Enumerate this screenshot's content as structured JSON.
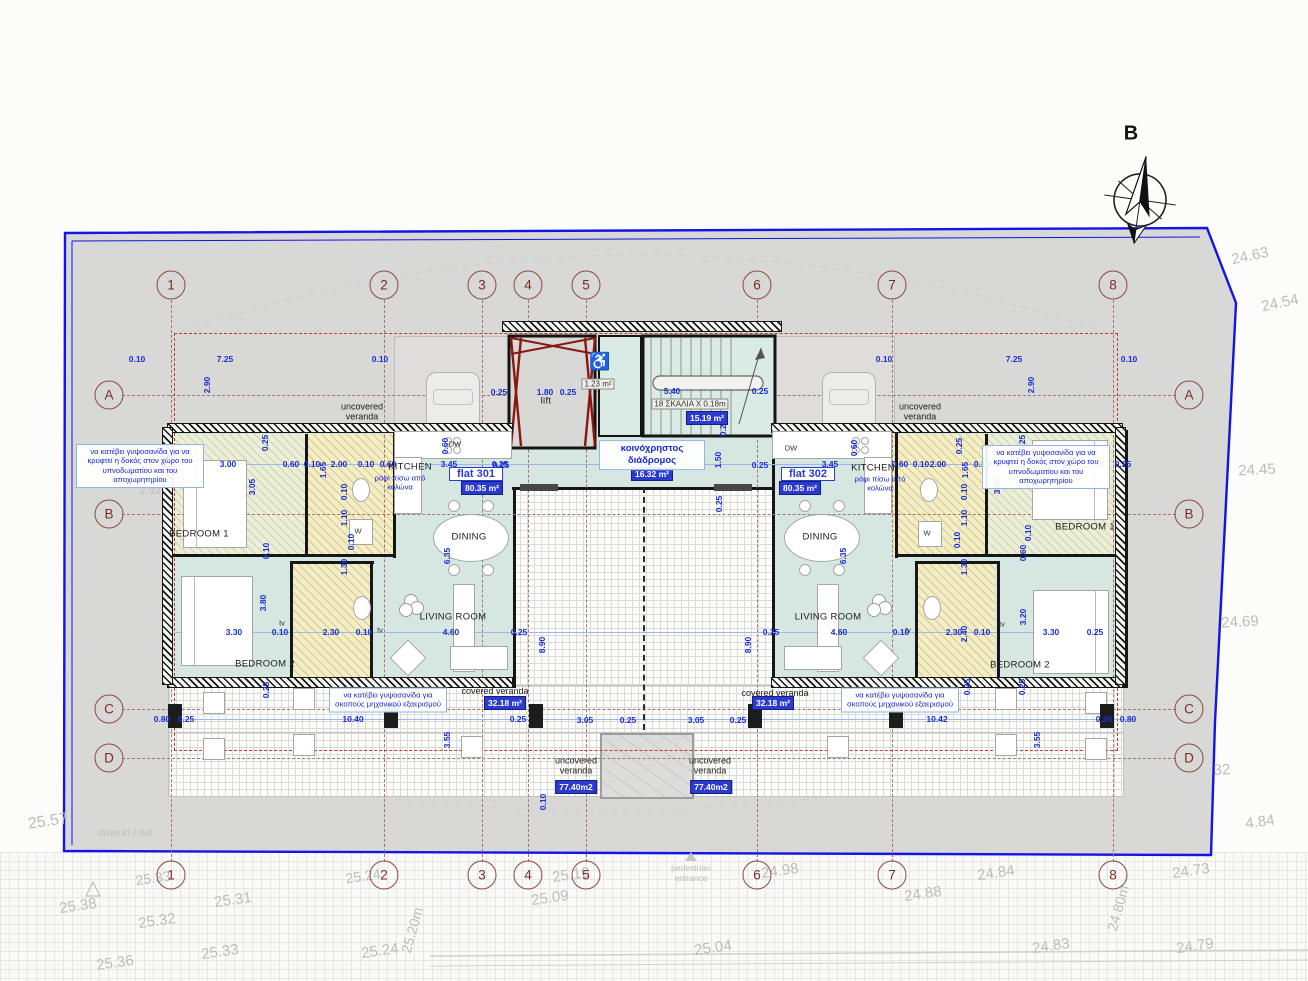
{
  "north": {
    "label": "B"
  },
  "site": {
    "drive": "drive in / out",
    "pedestrian": "pedestrian entrance",
    "boundary_color": "#1414e6"
  },
  "grid": {
    "cols": [
      {
        "n": "1",
        "x": 171
      },
      {
        "n": "2",
        "x": 384
      },
      {
        "n": "3",
        "x": 482
      },
      {
        "n": "4",
        "x": 528
      },
      {
        "n": "5",
        "x": 586
      },
      {
        "n": "6",
        "x": 757
      },
      {
        "n": "7",
        "x": 892
      },
      {
        "n": "8",
        "x": 1113
      }
    ],
    "rows": [
      {
        "n": "A",
        "y": 395
      },
      {
        "n": "B",
        "y": 514
      },
      {
        "n": "C",
        "y": 709
      },
      {
        "n": "D",
        "y": 758
      }
    ]
  },
  "flats": [
    {
      "name": "flat 301",
      "area": "80.35 m²"
    },
    {
      "name": "flat 302",
      "area": "80.35 m²"
    }
  ],
  "core": {
    "lift_label": "lift",
    "accessible": "♿",
    "wc_area": "1.23 m²",
    "stair_note": "18 ΣΚΑΛΙΑ X 0.18m",
    "stair_area": "15.19 m²",
    "corridor_label": "κοινόχρηστος διάδρομος",
    "corridor_area": "16.32 m²"
  },
  "rooms": [
    [
      "KITCHEN",
      410,
      467
    ],
    [
      "KITCHEN",
      873,
      468
    ],
    [
      "DINING",
      469,
      537
    ],
    [
      "DINING",
      820,
      537
    ],
    [
      "LIVING ROOM",
      453,
      617
    ],
    [
      "LIVING ROOM",
      828,
      617
    ],
    [
      "BEDROOM 1",
      199,
      534
    ],
    [
      "BEDROOM 1",
      1085,
      527
    ],
    [
      "BEDROOM 2",
      265,
      664
    ],
    [
      "BEDROOM 2",
      1020,
      665
    ],
    [
      "lift",
      546,
      401
    ]
  ],
  "verandas": [
    [
      "uncovered veranda",
      362,
      412,
      0
    ],
    [
      "uncovered veranda",
      920,
      412,
      0
    ],
    [
      "uncovered veranda",
      576,
      766,
      0
    ],
    [
      "uncovered veranda",
      710,
      766,
      0
    ],
    [
      "covered veranda",
      495,
      691,
      1
    ],
    [
      "covered veranda",
      775,
      693,
      1
    ]
  ],
  "badges": [
    [
      "80.35 m²",
      482,
      488
    ],
    [
      "80.35 m²",
      800,
      488
    ],
    [
      "16.32 m²",
      652,
      474
    ],
    [
      "15.19 m²",
      707,
      418
    ],
    [
      "32.18 m²",
      505,
      703
    ],
    [
      "32.18 m²",
      773,
      703
    ],
    [
      "77.40m2",
      576,
      787
    ],
    [
      "77.40m2",
      711,
      787
    ]
  ],
  "chips": [
    [
      "flat 301",
      476,
      474
    ],
    [
      "flat 302",
      808,
      474
    ]
  ],
  "grayboxes": [
    [
      "1.23 m²",
      598,
      384
    ],
    [
      "18 ΣΚΑΛΙΑ X 0.18m",
      690,
      404
    ]
  ],
  "appliances": [
    [
      "W",
      358,
      531
    ],
    [
      "W",
      927,
      533
    ],
    [
      "DW",
      455,
      444
    ],
    [
      "DW",
      791,
      448
    ],
    [
      "tv",
      282,
      623
    ],
    [
      "tv",
      380,
      630
    ],
    [
      "tv",
      1002,
      624
    ],
    [
      "tv",
      908,
      630
    ]
  ],
  "notes": [
    {
      "t": "να κατέβει γυψοσανίδα για να κρυφτεί η δοκός στον χώρο του υπνοδωματίου και του αποχωρητηρίου",
      "x": 140,
      "y": 466,
      "w": 120,
      "box": 1,
      "big": 0
    },
    {
      "t": "να κατέβει γυψοσανίδα για να κρυφτεί η δοκός στον χώρο του υπνοδωματίου και του αποχωρητηρίου",
      "x": 1046,
      "y": 467,
      "w": 120,
      "box": 1,
      "big": 0
    },
    {
      "t": "να κατέβει γυψοσανίδα για σκοπούς μηχανικού εξαερισμού",
      "x": 388,
      "y": 700,
      "w": 110,
      "box": 1,
      "big": 0
    },
    {
      "t": "να κατέβει γυψοσανίδα για σκοπούς μηχανικού εξαερισμού",
      "x": 900,
      "y": 700,
      "w": 110,
      "box": 1,
      "big": 0
    },
    {
      "t": "ράφι πίσω από κολώνα",
      "x": 400,
      "y": 483,
      "w": 64,
      "box": 0,
      "big": 0
    },
    {
      "t": "ράφι πίσω από κολώνα",
      "x": 880,
      "y": 484,
      "w": 64,
      "box": 0,
      "big": 0
    },
    {
      "t": "κοινόχρηστος διάδρομος",
      "x": 652,
      "y": 455,
      "w": 98,
      "box": 1,
      "big": 1
    }
  ],
  "dims": [
    [
      "0.10",
      137,
      359
    ],
    [
      "7.25",
      225,
      359
    ],
    [
      "0.10",
      380,
      359
    ],
    [
      "0.10",
      884,
      359
    ],
    [
      "7.25",
      1014,
      359
    ],
    [
      "0.10",
      1129,
      359
    ],
    [
      "2.90",
      207,
      385,
      1
    ],
    [
      "2.90",
      1031,
      385,
      1
    ],
    [
      "0.25",
      499,
      392
    ],
    [
      "1.80",
      545,
      392
    ],
    [
      "0.25",
      568,
      392
    ],
    [
      "5.40",
      672,
      391
    ],
    [
      "0.25",
      760,
      391
    ],
    [
      "0.25",
      723,
      428,
      1
    ],
    [
      "1.50",
      718,
      460,
      1
    ],
    [
      "0.25",
      719,
      504,
      1
    ],
    [
      "0.25",
      501,
      465
    ],
    [
      "7.45",
      650,
      467
    ],
    [
      "0.25",
      760,
      465
    ],
    [
      "0.25",
      167,
      464
    ],
    [
      "3.00",
      228,
      464
    ],
    [
      "0.60",
      291,
      464
    ],
    [
      "0.10",
      312,
      464
    ],
    [
      "2.00",
      339,
      464
    ],
    [
      "0.10",
      366,
      464
    ],
    [
      "0.60",
      388,
      464
    ],
    [
      "3.45",
      449,
      464
    ],
    [
      "0.25",
      500,
      464
    ],
    [
      "0.60",
      445,
      446,
      1
    ],
    [
      "0.25",
      265,
      443,
      1
    ],
    [
      "3.05",
      252,
      487,
      1
    ],
    [
      "0.10",
      266,
      551,
      1
    ],
    [
      "3.80",
      263,
      603,
      1
    ],
    [
      "6.35",
      447,
      556,
      1
    ],
    [
      "8.90",
      542,
      645,
      1
    ],
    [
      "1.65",
      323,
      470,
      1
    ],
    [
      "0.10",
      344,
      492,
      1
    ],
    [
      "1.10",
      344,
      518,
      1
    ],
    [
      "0.10",
      351,
      542,
      1
    ],
    [
      "1.30",
      344,
      567,
      1
    ],
    [
      "3.30",
      234,
      632
    ],
    [
      "0.10",
      280,
      632
    ],
    [
      "2.30",
      331,
      632
    ],
    [
      "0.10",
      364,
      632
    ],
    [
      "4.60",
      451,
      632
    ],
    [
      "0.25",
      519,
      632
    ],
    [
      "0.25",
      266,
      690,
      1
    ],
    [
      "0.80",
      162,
      719
    ],
    [
      "0.25",
      186,
      719
    ],
    [
      "10.40",
      353,
      719
    ],
    [
      "0.25",
      518,
      719
    ],
    [
      "3.55",
      447,
      740,
      1
    ],
    [
      "0.10",
      543,
      802,
      1
    ],
    [
      "3.05",
      585,
      720
    ],
    [
      "0.25",
      628,
      720
    ],
    [
      "3.05",
      696,
      720
    ],
    [
      "0.25",
      738,
      720
    ],
    [
      "3.45",
      830,
      464
    ],
    [
      "0.60",
      900,
      464
    ],
    [
      "0.10",
      921,
      464
    ],
    [
      "2.00",
      938,
      464
    ],
    [
      "0.10",
      982,
      464
    ],
    [
      "0.60",
      995,
      464
    ],
    [
      "3.00",
      1062,
      464
    ],
    [
      "0.25",
      1096,
      464
    ],
    [
      "0.25",
      1123,
      464
    ],
    [
      "0.60",
      854,
      448,
      1
    ],
    [
      "0.25",
      959,
      446,
      1
    ],
    [
      "0.25",
      1022,
      443,
      1
    ],
    [
      "1.65",
      965,
      470,
      1
    ],
    [
      "3.05",
      997,
      486,
      1
    ],
    [
      "0.10",
      964,
      492,
      1
    ],
    [
      "1.10",
      964,
      518,
      1
    ],
    [
      "0.10",
      957,
      540,
      1
    ],
    [
      "1.30",
      964,
      567,
      1
    ],
    [
      "0.10",
      1028,
      533,
      1
    ],
    [
      "0.60",
      1023,
      553,
      1
    ],
    [
      "3.20",
      1023,
      617,
      1
    ],
    [
      "6.35",
      843,
      556,
      1
    ],
    [
      "8.90",
      748,
      645,
      1
    ],
    [
      "0.25",
      771,
      632
    ],
    [
      "4.60",
      839,
      632
    ],
    [
      "0.10",
      901,
      632
    ],
    [
      "2.30",
      954,
      632
    ],
    [
      "2.40",
      964,
      634,
      1
    ],
    [
      "0.10",
      982,
      632
    ],
    [
      "3.30",
      1051,
      632
    ],
    [
      "0.25",
      1095,
      632
    ],
    [
      "0.25",
      967,
      687,
      1
    ],
    [
      "0.25",
      1022,
      687,
      1
    ],
    [
      "10.42",
      937,
      719
    ],
    [
      "0.25",
      1104,
      719
    ],
    [
      "0.80",
      1128,
      719
    ],
    [
      "3.55",
      1037,
      740,
      1
    ]
  ],
  "levels": [
    [
      "24.63",
      1250,
      256,
      12,
      15
    ],
    [
      "24.54",
      1280,
      303,
      12,
      15
    ],
    [
      "24.45",
      1257,
      470,
      3,
      15
    ],
    [
      "24.69",
      1240,
      622,
      3,
      15
    ],
    [
      "32",
      1222,
      770,
      3,
      15
    ],
    [
      "4.84",
      1260,
      822,
      8,
      15
    ],
    [
      "24.84",
      996,
      873,
      8,
      15
    ],
    [
      "24.88",
      923,
      894,
      8,
      15
    ],
    [
      "24.83",
      1051,
      946,
      8,
      15
    ],
    [
      "24.73",
      1191,
      871,
      8,
      15
    ],
    [
      "24.79",
      1195,
      946,
      8,
      15
    ],
    [
      "24.80m",
      1118,
      908,
      74,
      14
    ],
    [
      "24.98",
      780,
      871,
      8,
      15
    ],
    [
      "25.04",
      713,
      948,
      8,
      15
    ],
    [
      "25.09",
      550,
      898,
      8,
      15
    ],
    [
      "25.10",
      571,
      875,
      8,
      15
    ],
    [
      "25.24",
      380,
      951,
      8,
      15
    ],
    [
      "25.20m",
      412,
      930,
      74,
      14
    ],
    [
      "25.31",
      233,
      900,
      8,
      15
    ],
    [
      "25.32",
      157,
      921,
      8,
      15
    ],
    [
      "25.33",
      220,
      952,
      8,
      15
    ],
    [
      "25.36",
      115,
      963,
      8,
      15
    ],
    [
      "25.38",
      78,
      906,
      8,
      15
    ],
    [
      "25.57",
      48,
      822,
      8,
      16
    ],
    [
      "2.92",
      150,
      491,
      0,
      11
    ],
    [
      "25.33",
      153,
      878,
      8,
      14
    ],
    [
      "25.24",
      363,
      876,
      8,
      14
    ]
  ]
}
